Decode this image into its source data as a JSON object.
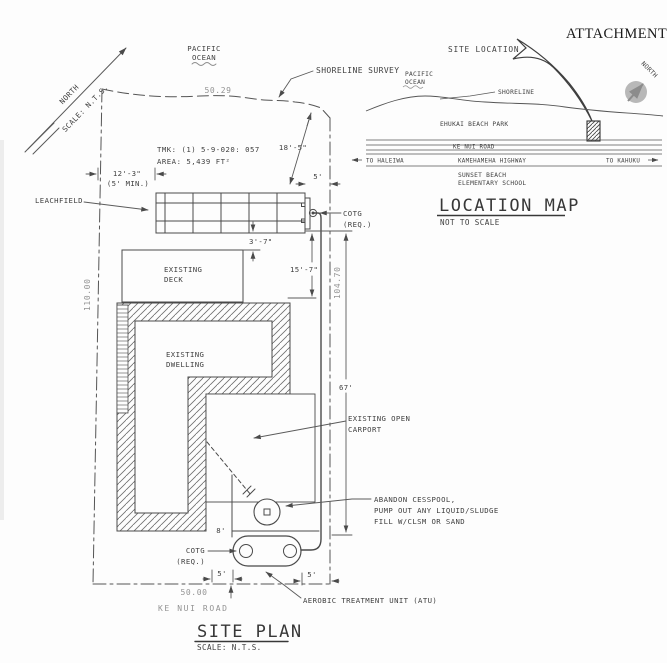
{
  "attachment_label": "ATTACHMENT F",
  "site_plan": {
    "title": "SITE PLAN",
    "title_scale": "SCALE: N.T.S.",
    "north_label": "NORTH",
    "north_scale": "SCALE: N.T.S.",
    "ocean_line1": "PACIFIC",
    "ocean_line2": "OCEAN",
    "shoreline_survey_label": "SHORELINE SURVEY",
    "tmk_line1": "TMK: (1) 5-9-020: 057",
    "tmk_line2": "AREA: 5,439 FT²",
    "leachfield_label": "LEACHFIELD",
    "cotg_top_line1": "COTG",
    "cotg_top_line2": "(REQ.)",
    "cotg_bottom_line1": "COTG",
    "cotg_bottom_line2": "(REQ.)",
    "deck_line1": "EXISTING",
    "deck_line2": "DECK",
    "dwelling_line1": "EXISTING",
    "dwelling_line2": "DWELLING",
    "carport_line1": "EXISTING OPEN",
    "carport_line2": "CARPORT",
    "cesspool_note_line1": "ABANDON CESSPOOL,",
    "cesspool_note_line2": "PUMP OUT ANY LIQUID/SLUDGE",
    "cesspool_note_line3": "FILL W/CLSM OR SAND",
    "atu_label": "AEROBIC TREATMENT UNIT (ATU)",
    "road_label": "KE NUI ROAD",
    "dim_top": "50.29",
    "dim_left": "110.00",
    "dim_right": "104.70",
    "dim_bottom": "50.00",
    "dim_shoreline_setback": "18'-5\"",
    "dim_leach_offset_1": "12'-3\"",
    "dim_leach_offset_2": "(5' MIN.)",
    "dim_leach_side": "5'",
    "dim_leach_deck_gap": "3'-7\"",
    "dim_deck_gap": "15'-7\"",
    "dim_cesspool_run": "67'",
    "dim_house_atu": "8'",
    "dim_atu_left": "5'",
    "dim_atu_right": "5'"
  },
  "location_map": {
    "title": "LOCATION MAP",
    "subtitle": "NOT TO SCALE",
    "site_location_label": "SITE LOCATION",
    "ocean_line1": "PACIFIC",
    "ocean_line2": "OCEAN",
    "shoreline_label": "SHORELINE",
    "park_label": "EHUKAI BEACH PARK",
    "road1_label": "KE NUI ROAD",
    "to_left": "TO HALEIWA",
    "road2_label": "KAMEHAMEHA HIGHWAY",
    "to_right": "TO KAHUKU",
    "school_line1": "SUNSET BEACH",
    "school_line2": "ELEMENTARY SCHOOL",
    "north_label": "NORTH"
  },
  "colors": {
    "line": "#4a4a4a",
    "text": "#3f3f3f",
    "dim_gray": "#939393",
    "north_circle": "#b8b8b8",
    "paper": "#fdfdfd"
  }
}
